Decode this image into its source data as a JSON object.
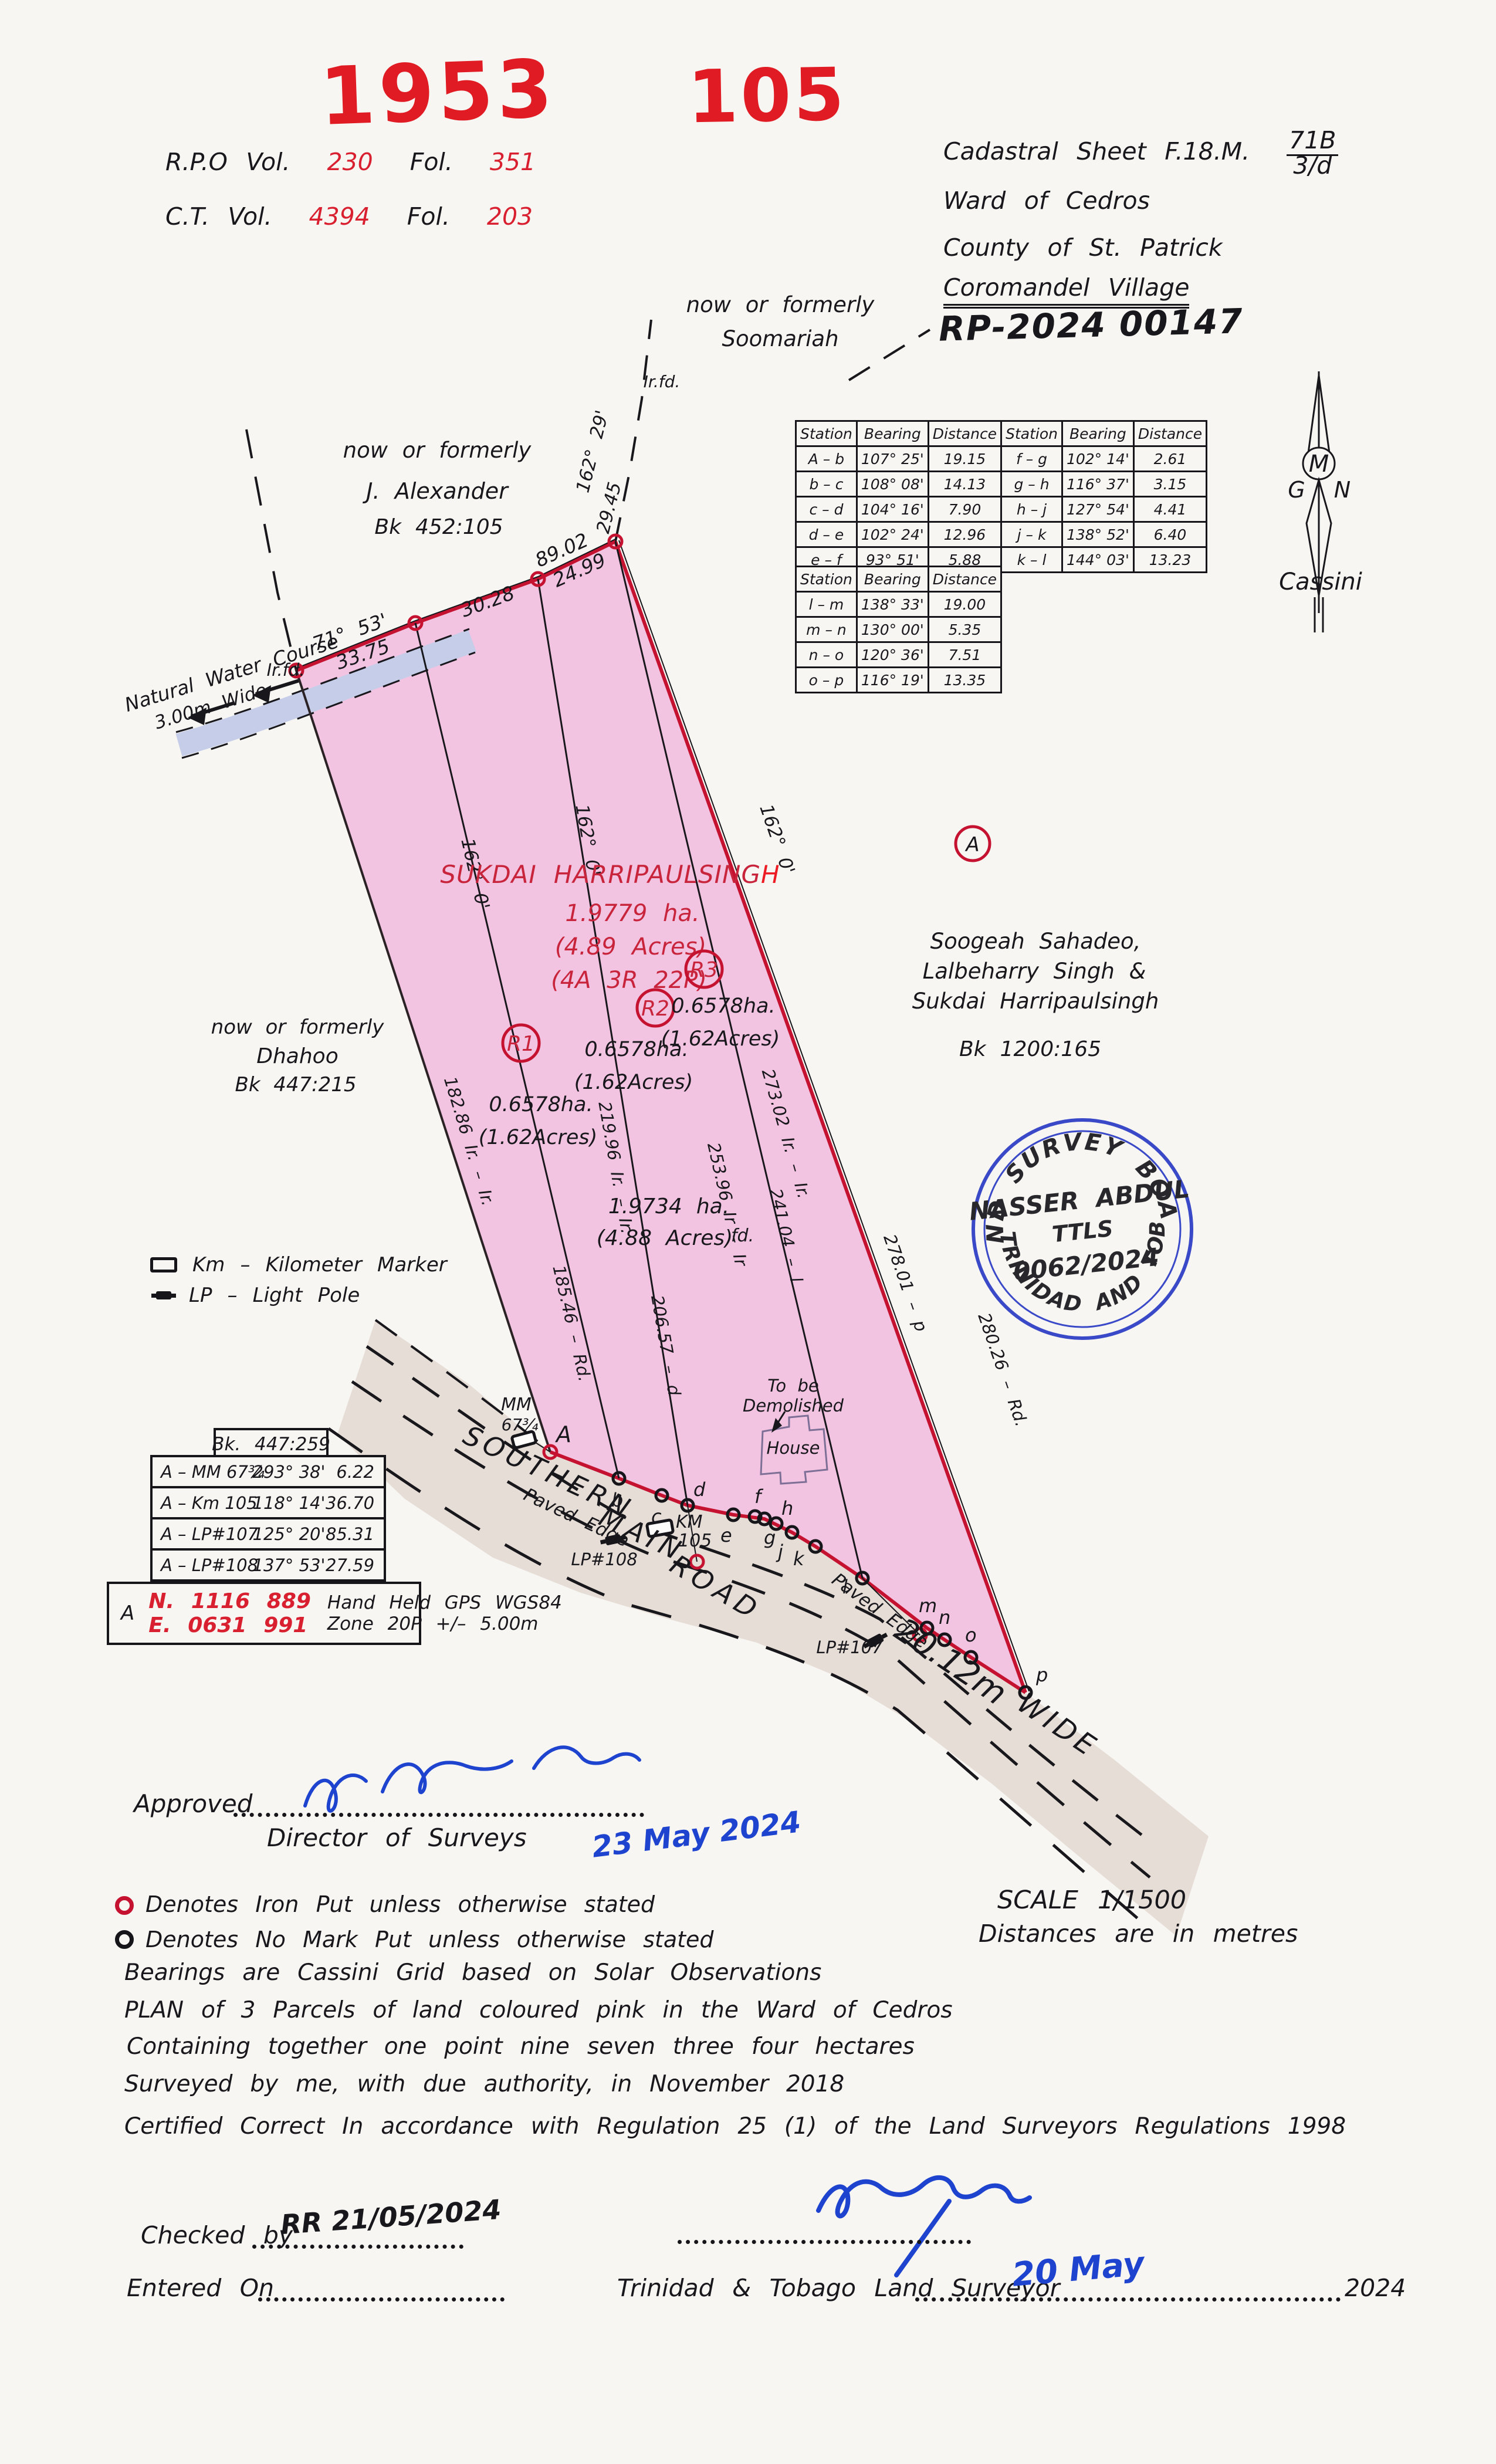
{
  "stamps": {
    "year": "1953",
    "number": "105"
  },
  "registry": {
    "rpo_label": "R.P.O Vol.",
    "rpo_vol": "230",
    "rpo_fol_label": "Fol.",
    "rpo_fol": "351",
    "ct_label": "C.T. Vol.",
    "ct_vol": "4394",
    "ct_fol_label": "Fol.",
    "ct_fol": "203"
  },
  "header": {
    "cadastral_label": "Cadastral Sheet F.18.M.",
    "sheet_top": "71B",
    "sheet_bottom": "3/d",
    "ward": "Ward of Cedros",
    "county": "County of St. Patrick",
    "village": "Coromandel Village",
    "rp_number": "RP-2024 00147"
  },
  "north_arrow": {
    "g": "G",
    "m": "M",
    "n": "N",
    "label": "Cassini"
  },
  "bearing_tables": {
    "col_station": "Station",
    "col_bearing": "Bearing",
    "col_distance": "Distance",
    "t1_left": [
      {
        "s": "A – b",
        "b": "107° 25'",
        "d": "19.15"
      },
      {
        "s": "b – c",
        "b": "108° 08'",
        "d": "14.13"
      },
      {
        "s": "c – d",
        "b": "104° 16'",
        "d": "7.90"
      },
      {
        "s": "d – e",
        "b": "102° 24'",
        "d": "12.96"
      },
      {
        "s": "e – f",
        "b": "93° 51'",
        "d": "5.88"
      }
    ],
    "t1_right": [
      {
        "s": "f – g",
        "b": "102° 14'",
        "d": "2.61"
      },
      {
        "s": "g – h",
        "b": "116° 37'",
        "d": "3.15"
      },
      {
        "s": "h – j",
        "b": "127° 54'",
        "d": "4.41"
      },
      {
        "s": "j – k",
        "b": "138° 52'",
        "d": "6.40"
      },
      {
        "s": "k – l",
        "b": "144° 03'",
        "d": "13.23"
      }
    ],
    "t2": [
      {
        "s": "l – m",
        "b": "138° 33'",
        "d": "19.00"
      },
      {
        "s": "m – n",
        "b": "130° 00'",
        "d": "5.35"
      },
      {
        "s": "n – o",
        "b": "120° 36'",
        "d": "7.51"
      },
      {
        "s": "o – p",
        "b": "116° 19'",
        "d": "13.35"
      }
    ]
  },
  "neighbors": {
    "soomariah_1": "now or formerly",
    "soomariah_2": "Soomariah",
    "alexander_1": "now or formerly",
    "alexander_2": "J. Alexander",
    "alexander_3": "Bk 452:105",
    "dhahoo_1": "now or formerly",
    "dhahoo_2": "Dhahoo",
    "dhahoo_3": "Bk 447:215",
    "soogeah_1": "Soogeah Sahadeo,",
    "soogeah_2": "Lalbeharry Singh &",
    "soogeah_3": "Sukdai Harripaulsingh",
    "soogeah_4": "Bk 1200:165",
    "ref_a": "A"
  },
  "parcel": {
    "owner": "SUKDAI HARRIPAULSING",
    "owner_last": "H",
    "area_ha": "1.9779 ha.",
    "area_acres": "(4.89 Acres)",
    "area_arp": "(4A 3R 22P)",
    "r1": "R1",
    "r2": "R2",
    "r3": "R3",
    "r1_ha": "0.6578ha.",
    "r1_ac": "(1.62Acres)",
    "r2_ha": "0.6578ha.",
    "r2_ac": "(1.62Acres)",
    "r3_ha": "0.6578ha.",
    "r3_ac": "(1.62Acres)",
    "total_ha": "1.9734 ha.",
    "total_ac": "(4.88 Acres)",
    "fd": "fd."
  },
  "boundary_labels": {
    "wc_name": "Natural Water Course",
    "wc_width": "3.00m Wide",
    "irfd": "Ir.fd.",
    "irfd2": "Ir.fd.",
    "b7153": "71° 53'",
    "d3375": "33.75",
    "d3028": "30.28",
    "d8902": "89.02",
    "d2499": "24.99",
    "b16229": "162° 29'",
    "d2945": "29.45",
    "b162_a": "162° 0'",
    "b162_b": "162° 0'",
    "b162_r": "162° 0'",
    "l18286": "182.86 Ir. – Ir.",
    "l18546": "185.46 – Rd.",
    "l21996": "219.96 Ir. – Ir.",
    "l20657": "206.57 – d",
    "l25396": "253.96 Ir – Ir",
    "l24104": "241.04 – l",
    "l27302": "273.02 Ir. – Ir.",
    "l27801": "278.01 – p",
    "l28026": "280.26 – Rd."
  },
  "road": {
    "n1": "SOUTHERN",
    "n2": "MAIN",
    "n3": "ROAD",
    "width": "20.12m",
    "wide": "WIDE",
    "paved1": "Paved Edge",
    "paved2": "Paved Edge",
    "mm1": "MM",
    "mm2": "67¾",
    "km1": "KM",
    "km2": "105",
    "lp107": "LP#107",
    "lp108": "LP#108",
    "house": "House",
    "demo1": "To be",
    "demo2": "Demolished"
  },
  "points": {
    "A": "A",
    "b": "b",
    "c": "c",
    "d": "d",
    "e": "e",
    "f": "f",
    "g": "g",
    "h": "h",
    "j": "j",
    "k": "k",
    "l": "l",
    "m": "m",
    "n": "n",
    "o": "o",
    "p": "p"
  },
  "seal": {
    "arc_top": "LAND SURVEY BOARD",
    "arc_bottom": "OF TRINIDAD AND TOBAGO",
    "name": "NASSER ABDUL",
    "title": "TTLS",
    "number": "0062/2024"
  },
  "legend": {
    "km": "Km – Kilometer Marker",
    "lp": "LP – Light Pole"
  },
  "tie_table": {
    "title": "Bk. 447:259",
    "rows": [
      {
        "s": "A – MM 67¾",
        "b": "293° 38'",
        "d": "6.22"
      },
      {
        "s": "A – Km 105",
        "b": "118° 14'",
        "d": "36.70"
      },
      {
        "s": "A – LP#107",
        "b": "125° 20'",
        "d": "85.31"
      },
      {
        "s": "A – LP#108",
        "b": "137° 53'",
        "d": "27.59"
      }
    ],
    "gps_point": "A",
    "gps_n": "N. 1116 889",
    "gps_e": "E. 0631 991",
    "gps_d1": "Hand Held GPS WGS84",
    "gps_d2": "Zone 20P +/– 5.00m"
  },
  "approval": {
    "label": "Approved",
    "director": "Director of Surveys",
    "date": "23 May 2024"
  },
  "notes": {
    "iron": "Denotes Iron Put unless otherwise stated",
    "nomark": "Denotes No Mark Put unless otherwise stated",
    "bearings": "Bearings are Cassini Grid based on Solar Observations",
    "plan": "PLAN of 3 Parcels of land coloured pink in the Ward of Cedros",
    "containing": "Containing together one point nine seven three four hectares",
    "surveyed": "Surveyed by me, with due authority, in November 2018",
    "certified": "Certified Correct In accordance with Regulation 25 (1) of the Land Surveyors Regulations 1998",
    "scale": "SCALE 1/1500",
    "distances": "Distances are in metres"
  },
  "footer": {
    "checked": "Checked by",
    "checked_hand": "RR  21/05/2024",
    "entered": "Entered On",
    "surveyor": "Trinidad & Tobago Land Surveyor",
    "year": "2024",
    "date_hand": "20 May"
  }
}
